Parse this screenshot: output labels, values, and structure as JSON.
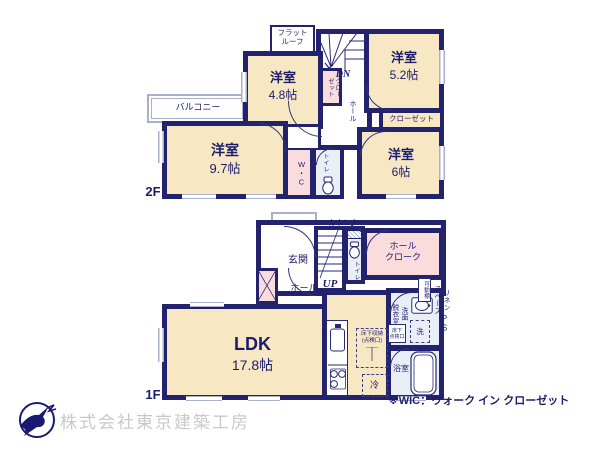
{
  "colors": {
    "wall": "#23236d",
    "room_fill": "#f8e7c3",
    "closet_fill": "#fadcdc",
    "wet_area_fill": "#eaeef7",
    "window_line": "#a9b1ce",
    "text": "#1c1c6e",
    "company_text": "#c9c9c9"
  },
  "floor2": {
    "floor_label": "2F",
    "flat_roof": "フラット\nルーフ",
    "balcony": "バルコニー",
    "stairs_dn": "DN",
    "hall": "ホール",
    "closet_stairs": "クロー\nゼット",
    "room_a_name": "洋室",
    "room_a_size": "4.8帖",
    "room_b_name": "洋室",
    "room_b_size": "5.2帖",
    "closet_b": "クローゼット",
    "room_c_name": "洋室",
    "room_c_size": "9.7帖",
    "room_d_name": "洋室",
    "room_d_size": "6帖",
    "wic": "W・C",
    "toilet": "トイレ"
  },
  "floor1": {
    "floor_label": "1F",
    "entrance": "玄関",
    "hall": "ホール",
    "stairs_up": "UP",
    "toilet": "トイレ",
    "counter": "カウンター",
    "hall_cloak": "ホール\nクローク",
    "ldk_name": "LDK",
    "ldk_size": "17.8帖",
    "underfloor_storage": "床下収納\n(点検口)",
    "fridge": "冷",
    "washroom": "洗面\n脱衣室",
    "washer": "洗",
    "underfloor_hatch": "床下\n点検口",
    "bath": "浴室",
    "movable_shelf": "可動棚",
    "linen_space": "リネン\nスペース",
    "ps": "PS"
  },
  "footer": {
    "wic_note": "※WIC：ウォーク イン クローゼット",
    "company": "株式会社東京建築工房"
  }
}
